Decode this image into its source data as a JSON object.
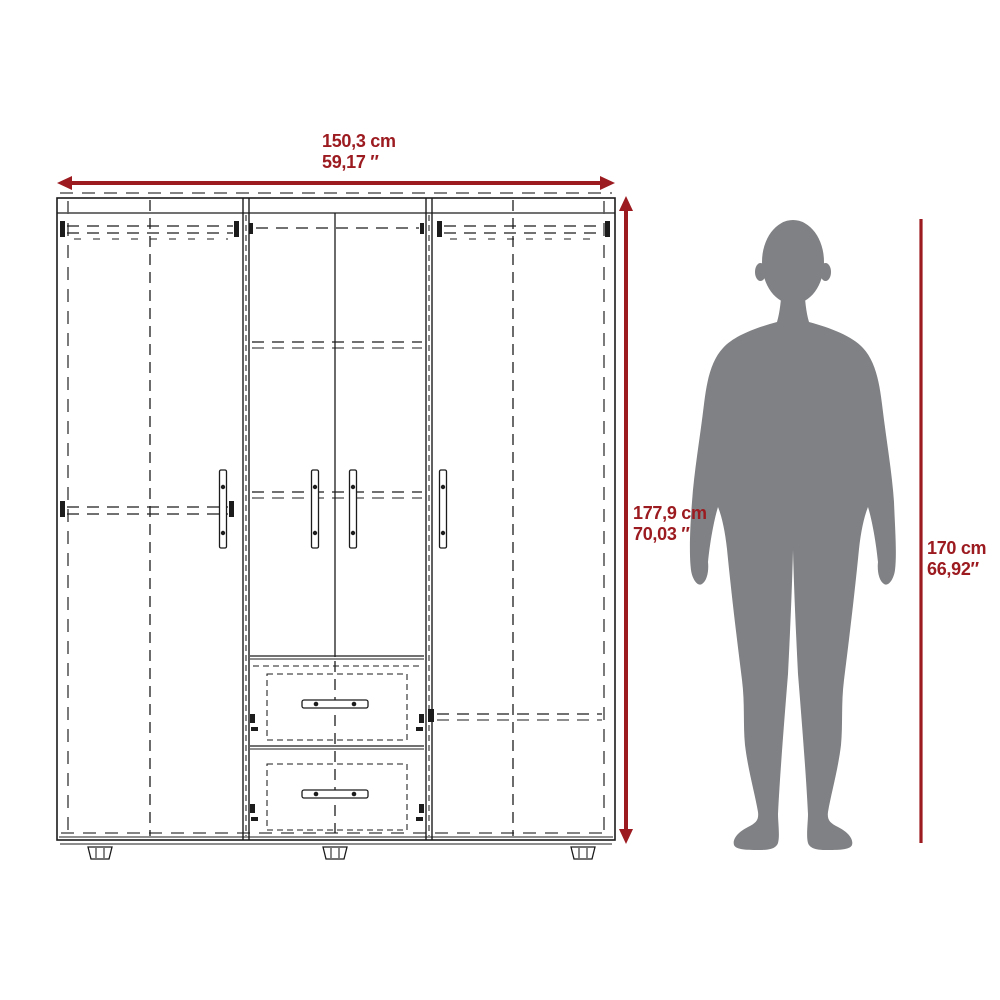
{
  "colors": {
    "accent": "#9C1B20",
    "line": "#1C1C1C",
    "line_soft": "#5A5A5A",
    "silhouette": "#808184"
  },
  "dimensions": {
    "width": {
      "metric": "150,3 cm",
      "imperial": "59,17 ″"
    },
    "height": {
      "metric": "177,9 cm",
      "imperial": "70,03 ″"
    },
    "person_height": {
      "metric": "170 cm",
      "imperial": "66,92″"
    }
  }
}
